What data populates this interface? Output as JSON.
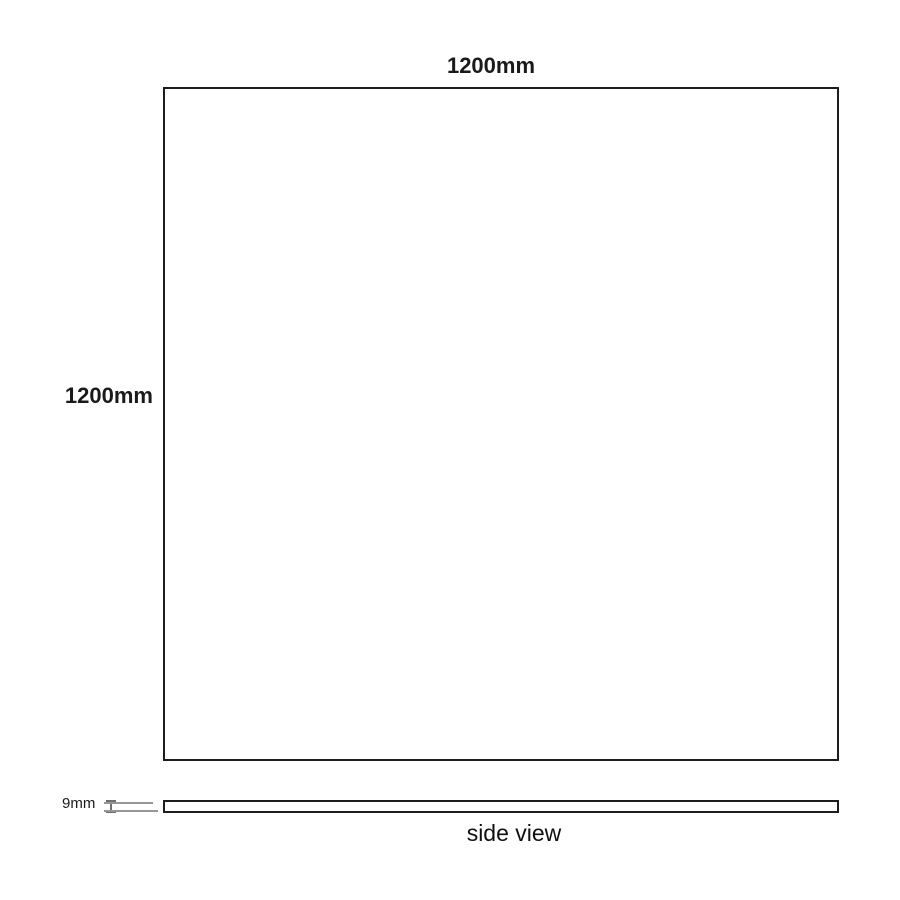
{
  "diagram": {
    "labels": {
      "top_dimension": "1200mm",
      "left_dimension": "1200mm",
      "thickness": "9mm",
      "caption": "side view"
    },
    "colors": {
      "background": "#ffffff",
      "outline": "#1d1d1b",
      "dimension_line_gray": "#969696",
      "text": "#1a1a1a"
    }
  }
}
